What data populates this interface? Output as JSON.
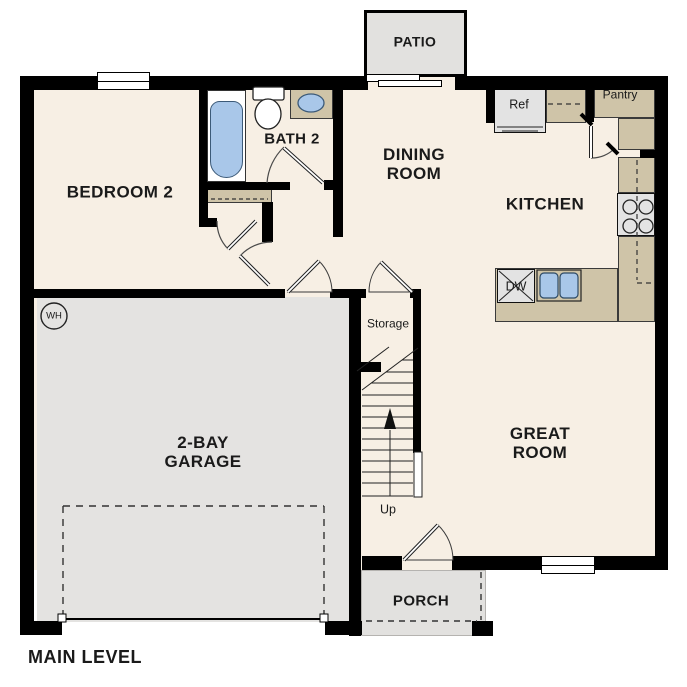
{
  "plan": {
    "title": "MAIN LEVEL",
    "rooms": {
      "bedroom2": "BEDROOM 2",
      "bath2": "BATH 2",
      "dining": [
        "DINING",
        "ROOM"
      ],
      "kitchen": "KITCHEN",
      "great": [
        "GREAT",
        "ROOM"
      ],
      "garage": [
        "2-BAY",
        "GARAGE"
      ]
    },
    "areas": {
      "patio": "PATIO",
      "porch": "PORCH",
      "storage": "Storage",
      "pantry": "Pantry",
      "stairs_direction": "Up"
    },
    "fixtures": {
      "refrigerator": "Ref",
      "dishwasher": "DW",
      "water_heater": "WH"
    },
    "colors": {
      "floor": "#f7efe4",
      "garage": "#e4e3e1",
      "outdoor": "#e2e1df",
      "counter": "#cfc4a8",
      "fixture": "#a9c7e9",
      "appliance": "#e3e3e3",
      "wall": "#000000",
      "text": "#1a1a1a"
    }
  }
}
